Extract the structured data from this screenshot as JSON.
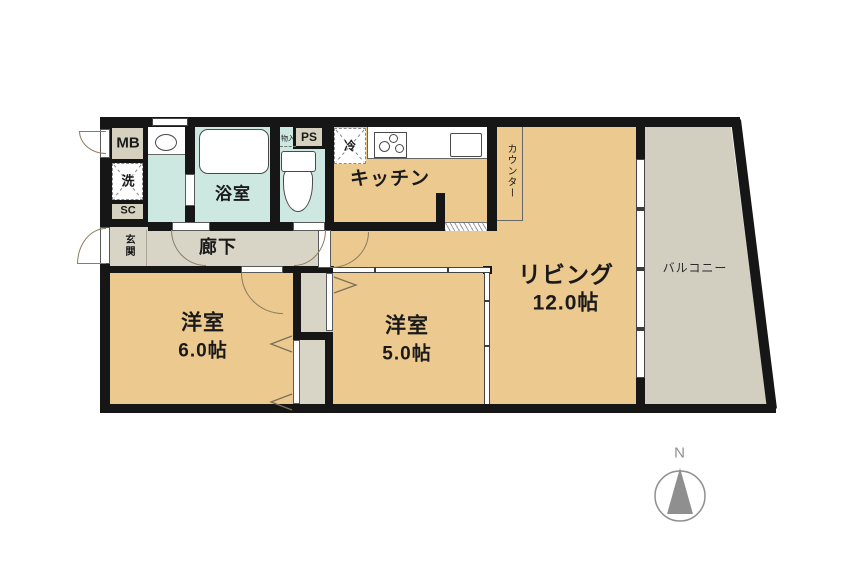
{
  "rooms": {
    "living": {
      "label": "リビング",
      "size": "12.0帖"
    },
    "bedroom_a": {
      "label": "洋室",
      "size": "6.0帖"
    },
    "bedroom_b": {
      "label": "洋室",
      "size": "5.0帖"
    },
    "kitchen": {
      "label": "キッチン"
    },
    "bathroom": {
      "label": "浴室"
    },
    "corridor": {
      "label": "廊下"
    },
    "entrance": {
      "label": "玄関"
    },
    "balcony": {
      "label": "バルコニー"
    },
    "counter": {
      "label": "カウンター"
    },
    "meter_box": {
      "label": "MB"
    },
    "washer": {
      "label": "洗"
    },
    "shoe_closet": {
      "label": "SC"
    },
    "pipe_space": {
      "label": "PS"
    },
    "storage": {
      "label": "物入"
    },
    "fridge": {
      "label": "冷"
    }
  },
  "compass": {
    "label": "N"
  },
  "colors": {
    "wall": "#161616",
    "room_floor": "#ebc98f",
    "service": "#d6d1bf",
    "corridor": "#d8d4c6",
    "water": "#cde7e1",
    "balcony": "#d2cfc1",
    "compass_gray": "#8f8f8f"
  }
}
